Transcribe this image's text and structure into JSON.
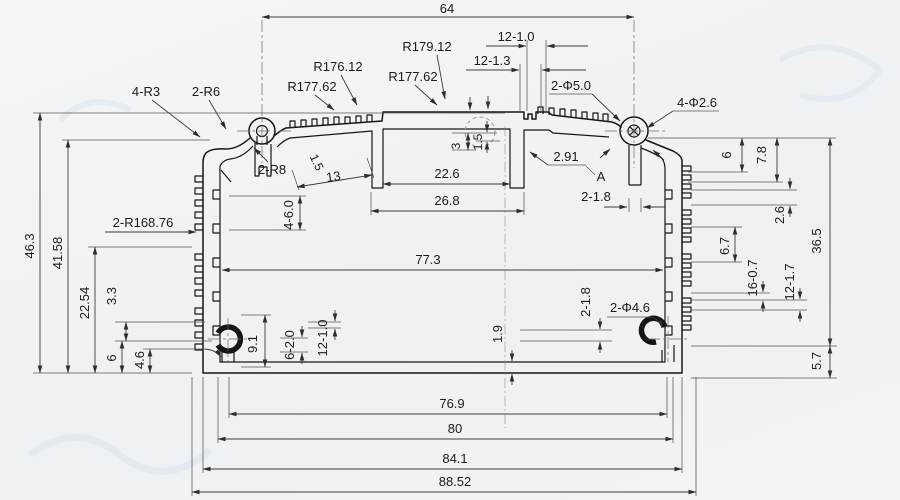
{
  "dims": {
    "top_width": "64",
    "slots_12_10_top": "12-1.0",
    "slots_12_13": "12-1.3",
    "r179": "R179.12",
    "r177_a": "R177.62",
    "r176": "R176.12",
    "r177_b": "R177.62",
    "corner_4r3": "4-R3",
    "corner_2r6": "2-R6",
    "hole_2d5": "2-Φ5.0",
    "hole_4d26": "4-Φ2.6",
    "gap_291": "2.91",
    "detail_a": "A",
    "fillet_2r8": "2-R8",
    "fin_15": "1.5",
    "fin_13": "13",
    "channel_226": "22.6",
    "channel_268": "26.8",
    "rib_3": "3",
    "rib_15": "1.5",
    "rib_218_top": "2-1.8",
    "right_6": "6",
    "right_78": "7.8",
    "right_26": "2.6",
    "right_365": "36.5",
    "right_67": "6.7",
    "right_16_07": "16-0.7",
    "right_12_17": "12-1.7",
    "right_57": "5.7",
    "left_463": "46.3",
    "left_4158": "41.58",
    "left_r16876": "2-R168.76",
    "left_2254": "22.54",
    "left_33": "3.3",
    "left_6": "6",
    "left_46": "4.6",
    "grooves_4_60": "4-6.0",
    "cavity_773": "77.3",
    "bot_91": "9.1",
    "bot_6_20": "6-2.0",
    "bot_12_10": "12-1.0",
    "floor_19": "1.9",
    "bot_218": "2-1.8",
    "hole_2d46": "2-Φ4.6",
    "w_769": "76.9",
    "w_80": "80",
    "w_841": "84.1",
    "w_8852": "88.52"
  }
}
